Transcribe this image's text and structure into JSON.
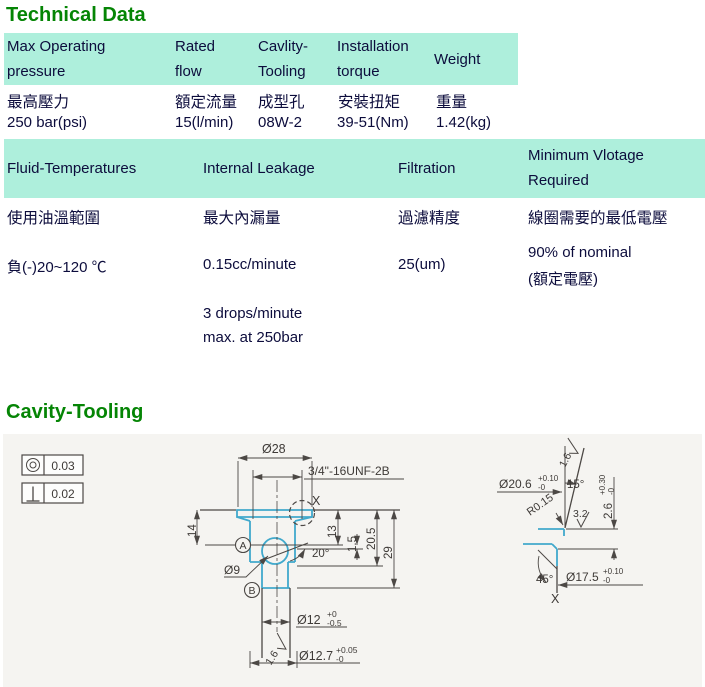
{
  "sections": {
    "technical_data_title": "Technical Data",
    "cavity_tooling_title": "Cavity-Tooling"
  },
  "colors": {
    "heading_green": "#058505",
    "table_header_bg": "#aeefdc",
    "table_text": "#0c0c3c",
    "drawing_bg": "#f5f4f1",
    "drawing_line": "#4c4845",
    "profile_accent": "#41a9cc"
  },
  "spec_table_1": {
    "headers": [
      "Max Operating pressure",
      "Rated flow",
      "Cavlity-Tooling",
      "Installation torque",
      "Weight"
    ],
    "labels_zh": [
      "最高壓力",
      "額定流量",
      "成型孔",
      "安裝扭矩",
      "重量"
    ],
    "values": [
      "250 bar(psi)",
      "15(l/min)",
      "08W-2",
      "39-51(Nm)",
      "1.42(kg)"
    ]
  },
  "spec_table_2": {
    "headers": [
      "Fluid-Temperatures",
      "Internal Leakage",
      "Filtration",
      "Minimum Vlotage Required"
    ],
    "labels_zh": [
      "使用油溫範圍",
      "最大內漏量",
      "過濾精度",
      "線圈需要的最低電壓"
    ],
    "values": [
      "負(-)20~120 ℃",
      "0.15cc/minute",
      "25(um)",
      "90% of nominal"
    ],
    "values_extra": {
      "leakage_line2": "3 drops/minute",
      "leakage_line3": "max. at 250bar",
      "voltage_line2": "(額定電壓)"
    }
  },
  "tolerance_frames": [
    {
      "symbol": "concentricity-icon",
      "value": "0.03"
    },
    {
      "symbol": "perpendicularity-icon",
      "value": "0.02"
    }
  ],
  "drawing_dims": {
    "dia28": "Ø28",
    "thread": "3/4\"-16UNF-2B",
    "detail_mark": "X",
    "len14": "14",
    "datum_a": "A",
    "len13": "13",
    "len1_5": "1.5",
    "len20_5": "20.5",
    "len29": "29",
    "angle20": "20°",
    "dia9": "Ø9",
    "datum_b": "B",
    "dia12": "Ø12",
    "dia12_tol_hi": "+0",
    "dia12_tol_lo": "-0.5",
    "finish_1_6": "1.6",
    "dia12_7": "Ø12.7",
    "dia12_7_tol_hi": "+0.05",
    "dia12_7_tol_lo": "-0"
  },
  "detail_dims": {
    "finish_1_6": "1.6",
    "dia20_6": "Ø20.6",
    "dia20_6_tol_hi": "+0.10",
    "dia20_6_tol_lo": "-0",
    "angle15": "15°",
    "radius": "R0.15",
    "finish_3_2": "3.2",
    "len2_6": "2.6",
    "len2_6_tol_hi": "+0.30",
    "len2_6_tol_lo": "-0",
    "angle45": "45°",
    "dia17_5": "Ø17.5",
    "dia17_5_tol_hi": "+0.10",
    "dia17_5_tol_lo": "-0",
    "detail_mark": "X"
  }
}
